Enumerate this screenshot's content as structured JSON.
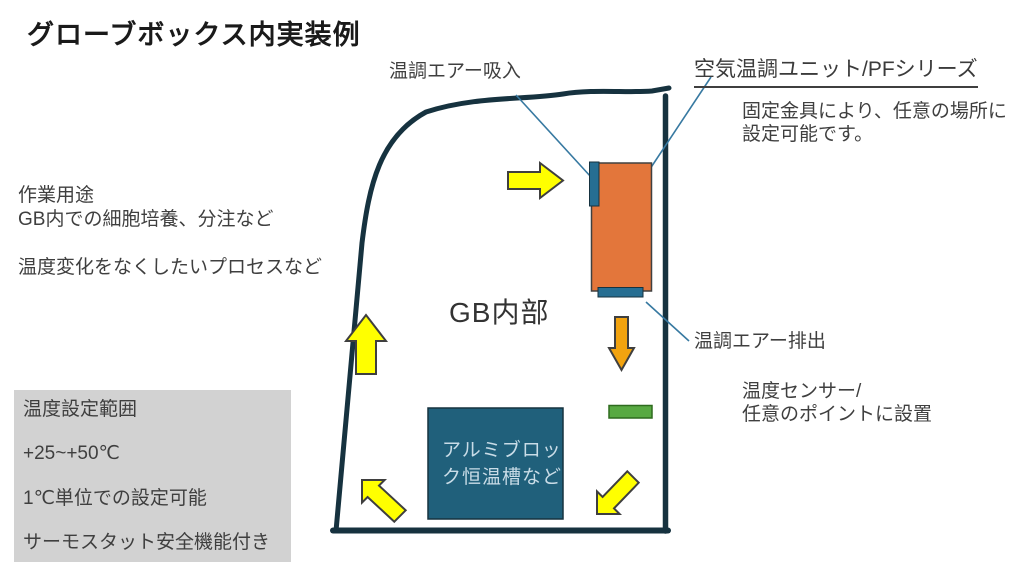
{
  "title": "グローブボックス内実装例",
  "colors": {
    "outline_navy": "#16323f",
    "leader_blue": "#3779a1",
    "unit_orange": "#e3763b",
    "duct_blue": "#266e92",
    "chamber_teal": "#20607b",
    "sensor_green": "#58a942",
    "arrow_yellow": "#ffff00",
    "arrow_orange": "#f2a30f",
    "panel_gray": "#d2d2d2"
  },
  "labels": {
    "intake": "温調エアー吸入",
    "unit_heading": "空気温調ユニット/PFシリーズ",
    "unit_note": "固定金具により、任意の場所に\n設定可能です。",
    "exhaust": "温調エアー排出",
    "sensor": "温度センサー/\n任意のポイントに設置",
    "gb_interior": "GB内部"
  },
  "left_notes": {
    "usage": "作業用途\nGB内での細胞培養、分注など\n\n温度変化をなくしたいプロセスなど"
  },
  "spec_panel": {
    "line1": "温度設定範囲",
    "line2": "+25~+50℃",
    "line3": "1℃単位での設定可能",
    "line4": "サーモスタット安全機能付き"
  },
  "chamber": {
    "line1": "アルミブロッ",
    "line2": "ク恒温槽など"
  }
}
